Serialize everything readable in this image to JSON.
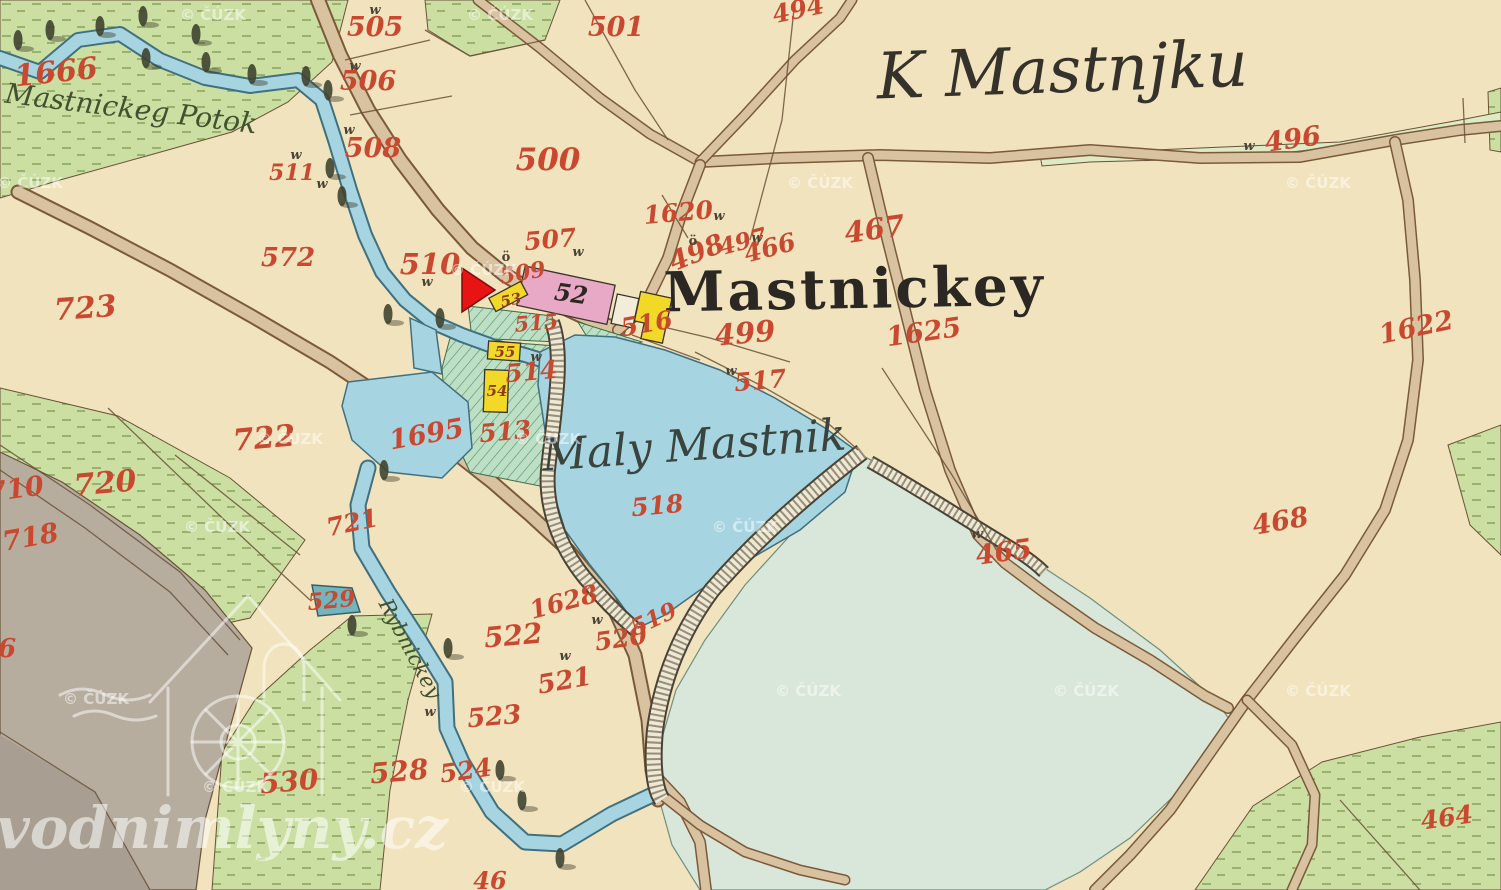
{
  "map": {
    "colors": {
      "field_cream": "#f1e3bd",
      "meadow_green": "#cbdfa3",
      "garden_green": "#bcdfc6",
      "water_blue": "#a6d4e0",
      "pale_pond": "#d8e7da",
      "gray_area": "#b6ad9f",
      "road_tan": "#d8c2a0",
      "building_pink": "#e8a9c6",
      "building_yellow": "#f2d827",
      "marker_red": "#e81414",
      "parcel_number_red": "#c8492f"
    },
    "watermarks": {
      "site": {
        "text": "vodnimlyny.cz"
      },
      "cuzk_text": "© ČÚZK"
    },
    "label_groups": [
      {
        "name": "place-label",
        "class": "place",
        "items": [
          {
            "t": "K Mastnjku",
            "x": 1063,
            "y": 92,
            "s": 64,
            "r": -2,
            "fill": "#35322b",
            "cls": "place"
          },
          {
            "t": "Mastnickey",
            "x": 855,
            "y": 308,
            "s": 55,
            "r": -1,
            "fill": "#2b2823",
            "cls": "place-bold",
            "ls": 3
          },
          {
            "t": "Maly Mastnik",
            "x": 695,
            "y": 460,
            "s": 44,
            "r": -4,
            "fill": "#3a433e",
            "cls": "place"
          },
          {
            "t": "Mastnickeg Potok",
            "x": 130,
            "y": 118,
            "s": 28,
            "r": 7,
            "fill": "#42512f",
            "cls": "place"
          },
          {
            "t": "Rybnickey",
            "x": 404,
            "y": 652,
            "s": 21,
            "r": 62,
            "fill": "#42512f",
            "cls": "place"
          }
        ]
      },
      {
        "name": "parcel-number",
        "class": "num",
        "fill": "#c8492f",
        "items": [
          {
            "t": "1666",
            "x": 57,
            "y": 82,
            "s": 30,
            "r": -6
          },
          {
            "t": "505",
            "x": 375,
            "y": 36,
            "s": 27
          },
          {
            "t": "506",
            "x": 368,
            "y": 90,
            "s": 27
          },
          {
            "t": "508",
            "x": 373,
            "y": 157,
            "s": 27
          },
          {
            "t": "511",
            "x": 292,
            "y": 180,
            "s": 22
          },
          {
            "t": "572",
            "x": 288,
            "y": 266,
            "s": 26
          },
          {
            "t": "723",
            "x": 86,
            "y": 318,
            "s": 30,
            "r": -4
          },
          {
            "t": "501",
            "x": 616,
            "y": 36,
            "s": 27
          },
          {
            "t": "500",
            "x": 548,
            "y": 170,
            "s": 31
          },
          {
            "t": "494",
            "x": 800,
            "y": 18,
            "s": 25,
            "r": -12
          },
          {
            "t": "496",
            "x": 1294,
            "y": 148,
            "s": 27,
            "r": -8
          },
          {
            "t": "507",
            "x": 551,
            "y": 248,
            "s": 25,
            "r": -5
          },
          {
            "t": "510",
            "x": 430,
            "y": 274,
            "s": 29
          },
          {
            "t": "509",
            "x": 524,
            "y": 280,
            "s": 22,
            "r": -10
          },
          {
            "t": "1620",
            "x": 679,
            "y": 221,
            "s": 25,
            "r": -5
          },
          {
            "t": "498",
            "x": 700,
            "y": 261,
            "s": 27,
            "r": -22
          },
          {
            "t": "497",
            "x": 745,
            "y": 249,
            "s": 23,
            "r": -15
          },
          {
            "t": "466",
            "x": 772,
            "y": 256,
            "s": 25,
            "r": -15
          },
          {
            "t": "467",
            "x": 876,
            "y": 239,
            "s": 29,
            "r": -8
          },
          {
            "t": "499",
            "x": 746,
            "y": 343,
            "s": 29,
            "r": -5
          },
          {
            "t": "1625",
            "x": 925,
            "y": 341,
            "s": 27,
            "r": -8
          },
          {
            "t": "1622",
            "x": 1418,
            "y": 336,
            "s": 27,
            "r": -12
          },
          {
            "t": "517",
            "x": 761,
            "y": 389,
            "s": 25,
            "r": -5
          },
          {
            "t": "515",
            "x": 537,
            "y": 330,
            "s": 21,
            "r": -5
          },
          {
            "t": "514",
            "x": 532,
            "y": 380,
            "s": 25,
            "r": -5
          },
          {
            "t": "513",
            "x": 506,
            "y": 440,
            "s": 25,
            "r": -5
          },
          {
            "t": "1695",
            "x": 428,
            "y": 443,
            "s": 27,
            "r": -10
          },
          {
            "t": "518",
            "x": 658,
            "y": 514,
            "s": 25,
            "r": -5
          },
          {
            "t": "465",
            "x": 1005,
            "y": 561,
            "s": 27,
            "r": -8
          },
          {
            "t": "468",
            "x": 1282,
            "y": 530,
            "s": 27,
            "r": -10
          },
          {
            "t": "722",
            "x": 265,
            "y": 448,
            "s": 30,
            "r": -5
          },
          {
            "t": "720",
            "x": 106,
            "y": 493,
            "s": 30,
            "r": -5
          },
          {
            "t": "710",
            "x": 17,
            "y": 498,
            "s": 27,
            "r": -8
          },
          {
            "t": "718",
            "x": 32,
            "y": 546,
            "s": 27,
            "r": -10
          },
          {
            "t": "721",
            "x": 354,
            "y": 531,
            "s": 25,
            "r": -12
          },
          {
            "t": "529",
            "x": 332,
            "y": 608,
            "s": 23,
            "r": -5
          },
          {
            "t": "1628",
            "x": 566,
            "y": 610,
            "s": 25,
            "r": -15
          },
          {
            "t": "522",
            "x": 514,
            "y": 645,
            "s": 28,
            "r": -5
          },
          {
            "t": "520",
            "x": 622,
            "y": 647,
            "s": 25,
            "r": -8
          },
          {
            "t": "519",
            "x": 657,
            "y": 626,
            "s": 23,
            "r": -25
          },
          {
            "t": "521",
            "x": 566,
            "y": 689,
            "s": 26,
            "r": -10
          },
          {
            "t": "523",
            "x": 495,
            "y": 725,
            "s": 26,
            "r": -5
          },
          {
            "t": "524",
            "x": 467,
            "y": 779,
            "s": 25,
            "r": -8
          },
          {
            "t": "528",
            "x": 400,
            "y": 781,
            "s": 28,
            "r": -5
          },
          {
            "t": "530",
            "x": 290,
            "y": 791,
            "s": 28,
            "r": -5
          },
          {
            "t": "464",
            "x": 1448,
            "y": 826,
            "s": 25,
            "r": -8
          },
          {
            "t": "516",
            "x": 648,
            "y": 332,
            "s": 25,
            "r": -10
          },
          {
            "t": "46",
            "x": 490,
            "y": 889,
            "s": 24
          },
          {
            "t": "6",
            "x": 7,
            "y": 657,
            "s": 26
          }
        ]
      },
      {
        "name": "house-number",
        "class": "housenum",
        "fill": "#8a3c1c",
        "items": [
          {
            "t": "53",
            "x": 512,
            "y": 305,
            "s": 15,
            "r": -12
          },
          {
            "t": "55",
            "x": 505,
            "y": 357,
            "s": 15
          },
          {
            "t": "54",
            "x": 497,
            "y": 396,
            "s": 15
          }
        ]
      },
      {
        "name": "house-number-script",
        "class": "script52",
        "fill": "#2b2823",
        "items": [
          {
            "t": "52",
            "x": 570,
            "y": 302,
            "s": 24,
            "r": 8
          }
        ]
      },
      {
        "name": "w-mark",
        "class": "wmark",
        "fill": "#4a4335",
        "text": "w",
        "s": 13,
        "items": [
          {
            "x": 375,
            "y": 14
          },
          {
            "x": 355,
            "y": 70
          },
          {
            "x": 349,
            "y": 134
          },
          {
            "x": 296,
            "y": 159
          },
          {
            "x": 322,
            "y": 188
          },
          {
            "x": 427,
            "y": 286
          },
          {
            "x": 536,
            "y": 361
          },
          {
            "x": 578,
            "y": 256
          },
          {
            "x": 719,
            "y": 220
          },
          {
            "x": 757,
            "y": 242
          },
          {
            "x": 1249,
            "y": 150
          },
          {
            "x": 731,
            "y": 375
          },
          {
            "x": 977,
            "y": 538
          },
          {
            "x": 597,
            "y": 624
          },
          {
            "x": 565,
            "y": 660
          },
          {
            "x": 430,
            "y": 716
          }
        ]
      },
      {
        "name": "o-mark",
        "class": "omark",
        "fill": "#4a4335",
        "text": "ö",
        "s": 13,
        "items": [
          {
            "x": 506,
            "y": 261
          },
          {
            "x": 693,
            "y": 245
          }
        ]
      },
      {
        "name": "cuzk-watermark",
        "class": "cuzk",
        "fill": "rgba(255,255,255,0.5)",
        "text": "© ČÚZK",
        "s": 15,
        "items": [
          {
            "x": 30,
            "y": 188
          },
          {
            "x": 213,
            "y": 20
          },
          {
            "x": 500,
            "y": 20
          },
          {
            "x": 820,
            "y": 188
          },
          {
            "x": 1318,
            "y": 188
          },
          {
            "x": 483,
            "y": 275
          },
          {
            "x": 290,
            "y": 444
          },
          {
            "x": 548,
            "y": 444
          },
          {
            "x": 745,
            "y": 532
          },
          {
            "x": 217,
            "y": 532
          },
          {
            "x": 96,
            "y": 704
          },
          {
            "x": 235,
            "y": 792
          },
          {
            "x": 492,
            "y": 792
          },
          {
            "x": 808,
            "y": 696
          },
          {
            "x": 1086,
            "y": 696
          },
          {
            "x": 1318,
            "y": 696
          }
        ]
      }
    ]
  }
}
